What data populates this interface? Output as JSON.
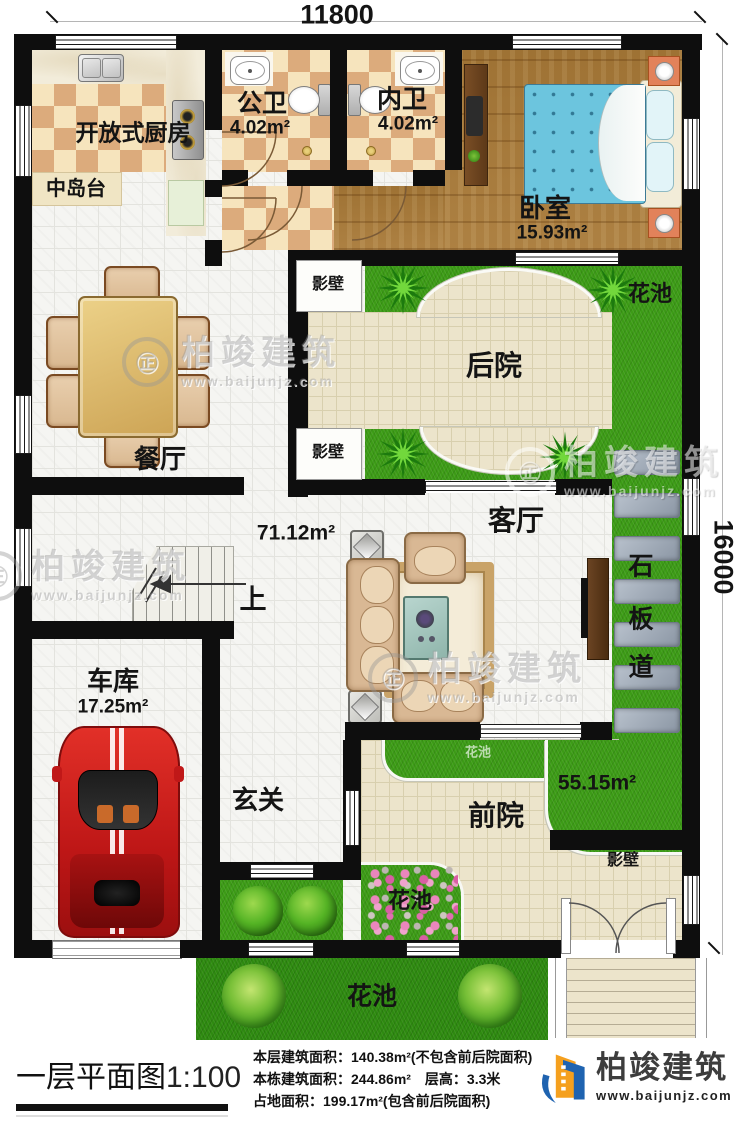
{
  "dimensions": {
    "top": "11800",
    "right": "16000"
  },
  "rooms": {
    "kitchen": {
      "label": "开放式厨房"
    },
    "island": {
      "label": "中岛台"
    },
    "public_bath": {
      "label": "公卫",
      "area": "4.02m²"
    },
    "private_bath": {
      "label": "内卫",
      "area": "4.02m²"
    },
    "bedroom": {
      "label": "卧室",
      "area": "15.93m²"
    },
    "dining": {
      "label": "餐厅"
    },
    "backyard": {
      "label": "后院"
    },
    "living": {
      "label": "客厅",
      "area": "71.12m²"
    },
    "garage": {
      "label": "车库",
      "area": "17.25m²"
    },
    "foyer": {
      "label": "玄关"
    },
    "front_yard": {
      "label": "前院",
      "area": "55.15m²"
    },
    "stone_path": {
      "chars": [
        "石",
        "板",
        "道"
      ]
    },
    "stairs_up": "上",
    "screen_wall": "影壁",
    "flower_bed": "花池"
  },
  "footer": {
    "plan_title": "一层平面图",
    "scale": "1:100",
    "stats": [
      "本层建筑面积：140.38m²(不包含前后院面积)",
      "本栋建筑面积：244.86m²　层高：3.3米",
      "占地面积：199.17m²(包含前后院面积)"
    ],
    "brand": {
      "name": "柏竣建筑",
      "site": "www.baijunjz.com"
    }
  },
  "watermark": {
    "name": "柏竣建筑",
    "site": "www.baijunjz.com"
  }
}
